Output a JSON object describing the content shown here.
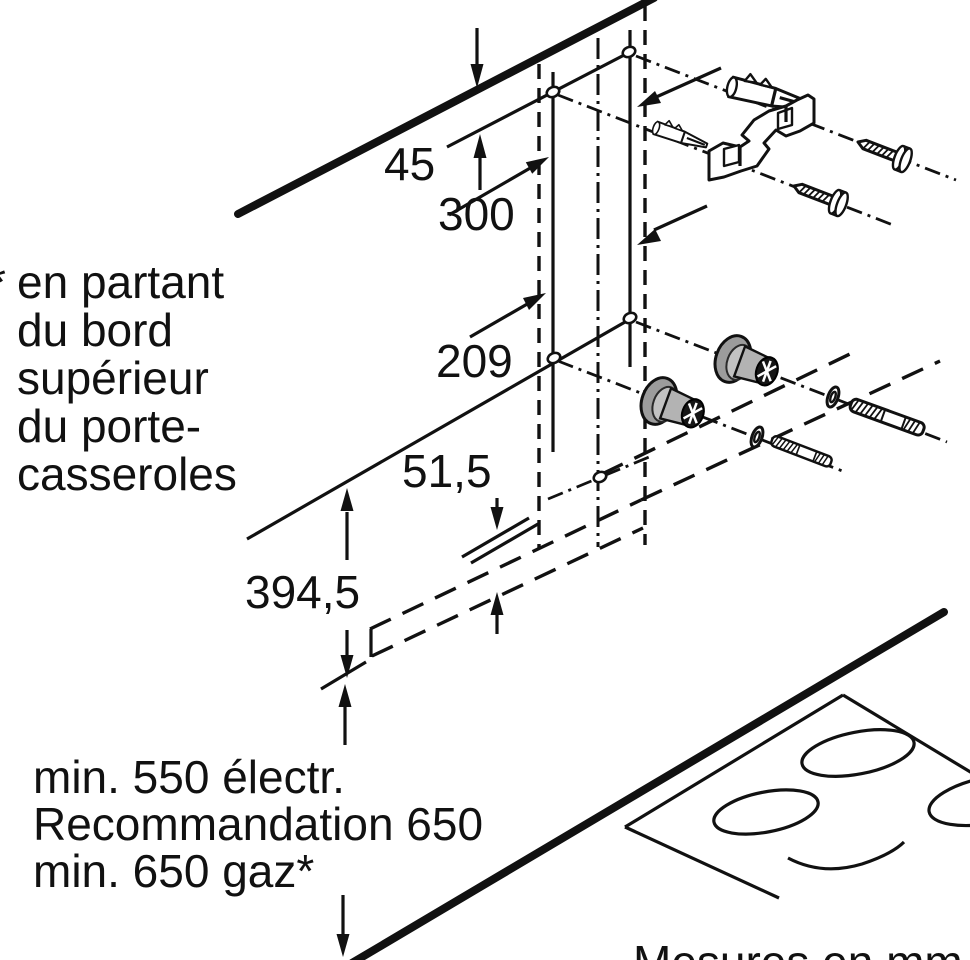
{
  "diagram": {
    "dimensions": {
      "wall_offset": "45",
      "hole_spacing": "300",
      "mid_height": "209",
      "lower_offset": "51,5",
      "body_height": "394,5"
    },
    "annotations": {
      "asterisk_marker": "*",
      "reference_lines": [
        "en partant",
        "du bord",
        "supérieur",
        "du porte-",
        "casseroles"
      ],
      "clearance_lines": [
        "min. 550 électr.",
        "Recommandation 650",
        "min. 650 gaz*"
      ],
      "units_note": "Mesures en mm"
    },
    "colors": {
      "ink": "#111111",
      "spacer_gray": "#9c9c9c",
      "background": "#ffffff"
    }
  }
}
